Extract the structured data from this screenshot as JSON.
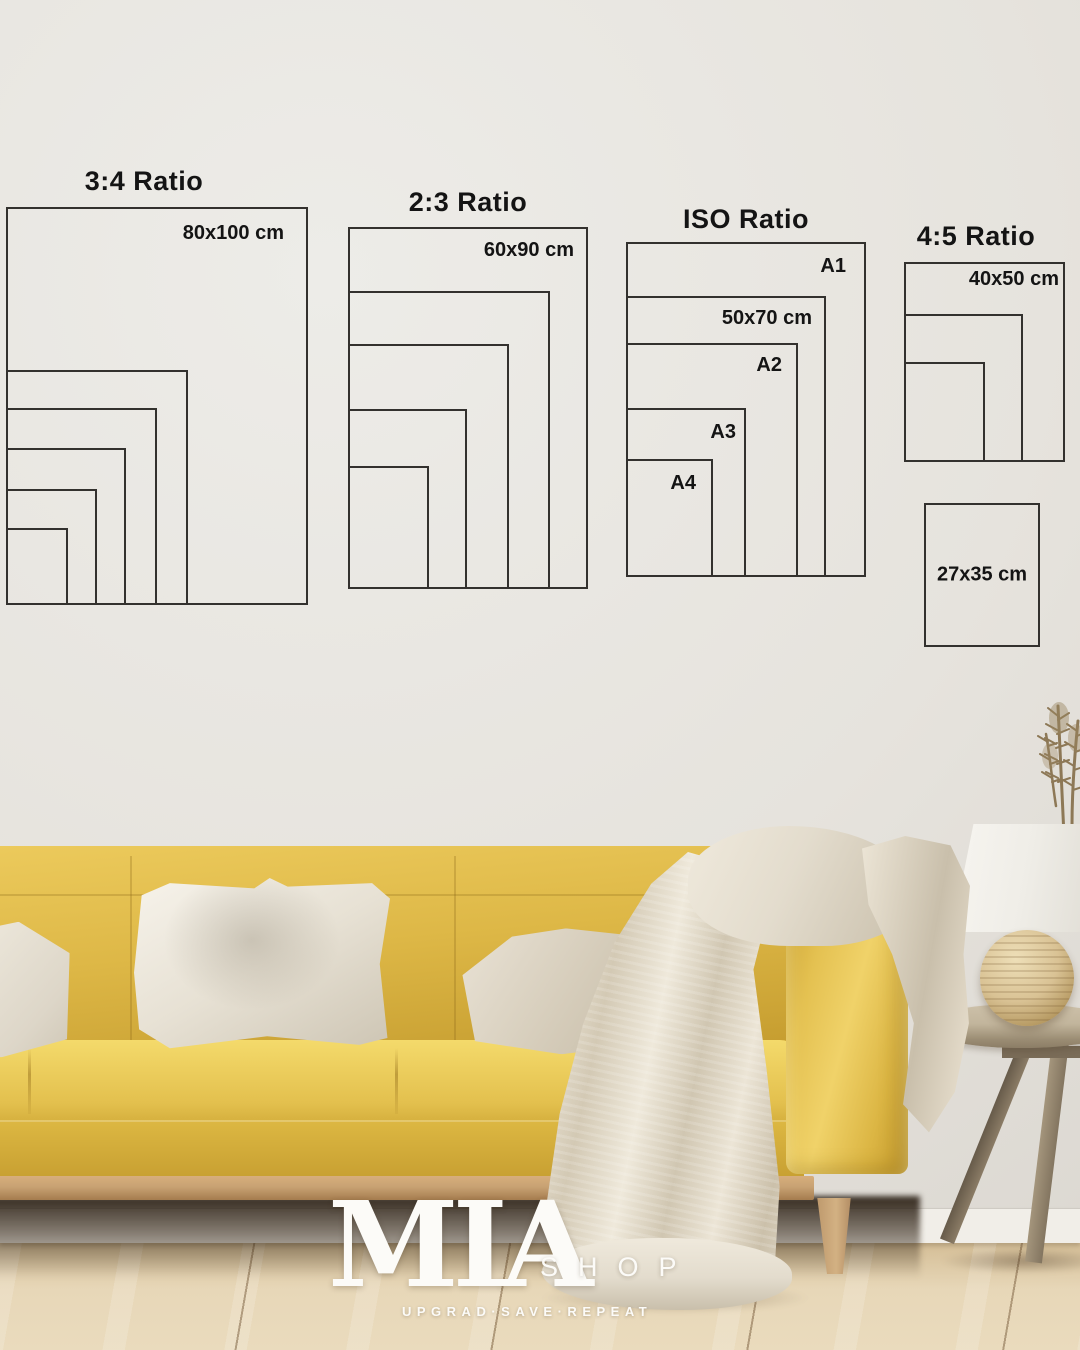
{
  "brand": {
    "logo_main": "MIA",
    "logo_suffix": "SHOP",
    "tagline": "UPGRAD·SAVE·REPEAT"
  },
  "palette": {
    "wall": "#e6e3dd",
    "wall_edge": "#d7d3cc",
    "line": "#33312e",
    "text": "#141414",
    "sofa": "#ddb746",
    "sofa_light": "#f0d269",
    "sofa_dark": "#c2992c",
    "pillow": "#efeade",
    "pillow_shadow": "#cfc7b6",
    "blanket": "#e3dccd",
    "blanket_shadow": "#c9bfab",
    "rail": "#c8a273",
    "leg": "#d3b183",
    "floor": "#e7d7b8",
    "floor_dark": "#d3bc94",
    "baseboard": "#f1eee8",
    "table": "#c2b59c",
    "table_dark": "#8c7d66",
    "lamp_shade": "#f7f5f0",
    "lamp_base": "#d9c294",
    "plant": "#8d7856",
    "logo": "#fcfbf8"
  },
  "size_guide": {
    "groups": [
      {
        "id": "ratio-3-4",
        "title": "3:4 Ratio",
        "title_x": 144,
        "title_y": 166,
        "frames": [
          {
            "x": 6,
            "y": 207,
            "w": 302,
            "h": 398,
            "label": "80x100 cm",
            "label_align": "right",
            "label_pad_x": 22,
            "label_pad_y": 13
          },
          {
            "x": 6,
            "y": 370,
            "w": 182,
            "h": 235
          },
          {
            "x": 6,
            "y": 408,
            "w": 151,
            "h": 197
          },
          {
            "x": 6,
            "y": 448,
            "w": 120,
            "h": 157
          },
          {
            "x": 6,
            "y": 489,
            "w": 91,
            "h": 116
          },
          {
            "x": 6,
            "y": 528,
            "w": 62,
            "h": 77
          }
        ]
      },
      {
        "id": "ratio-2-3",
        "title": "2:3 Ratio",
        "title_x": 468,
        "title_y": 187,
        "frames": [
          {
            "x": 348,
            "y": 227,
            "w": 240,
            "h": 362,
            "label": "60x90 cm",
            "label_align": "right",
            "label_pad_x": 12,
            "label_pad_y": 10
          },
          {
            "x": 348,
            "y": 291,
            "w": 202,
            "h": 298
          },
          {
            "x": 348,
            "y": 344,
            "w": 161,
            "h": 245
          },
          {
            "x": 348,
            "y": 409,
            "w": 119,
            "h": 180
          },
          {
            "x": 348,
            "y": 466,
            "w": 81,
            "h": 123
          }
        ]
      },
      {
        "id": "ratio-iso",
        "title": "ISO Ratio",
        "title_x": 746,
        "title_y": 204,
        "frames": [
          {
            "x": 626,
            "y": 242,
            "w": 240,
            "h": 335,
            "label": "A1",
            "label_align": "right",
            "label_pad_x": 18,
            "label_pad_y": 11
          },
          {
            "x": 626,
            "y": 296,
            "w": 200,
            "h": 281,
            "label": "50x70 cm",
            "label_align": "right",
            "label_pad_x": 12,
            "label_pad_y": 9
          },
          {
            "x": 626,
            "y": 343,
            "w": 172,
            "h": 234,
            "label": "A2",
            "label_align": "right",
            "label_pad_x": 14,
            "label_pad_y": 9
          },
          {
            "x": 626,
            "y": 408,
            "w": 120,
            "h": 169,
            "label": "A3",
            "label_align": "right",
            "label_pad_x": 8,
            "label_pad_y": 11
          },
          {
            "x": 626,
            "y": 459,
            "w": 87,
            "h": 118,
            "label": "A4",
            "label_align": "right",
            "label_pad_x": 15,
            "label_pad_y": 11
          }
        ]
      },
      {
        "id": "ratio-4-5",
        "title": "4:5 Ratio",
        "title_x": 976,
        "title_y": 221,
        "frames": [
          {
            "x": 904,
            "y": 262,
            "w": 161,
            "h": 200,
            "label": "40x50 cm",
            "label_align": "right",
            "label_pad_x": 4,
            "label_pad_y": 4
          },
          {
            "x": 904,
            "y": 314,
            "w": 119,
            "h": 148
          },
          {
            "x": 904,
            "y": 362,
            "w": 81,
            "h": 100
          },
          {
            "x": 924,
            "y": 503,
            "w": 116,
            "h": 144,
            "label": "27x35 cm",
            "label_align": "center"
          }
        ]
      }
    ]
  }
}
